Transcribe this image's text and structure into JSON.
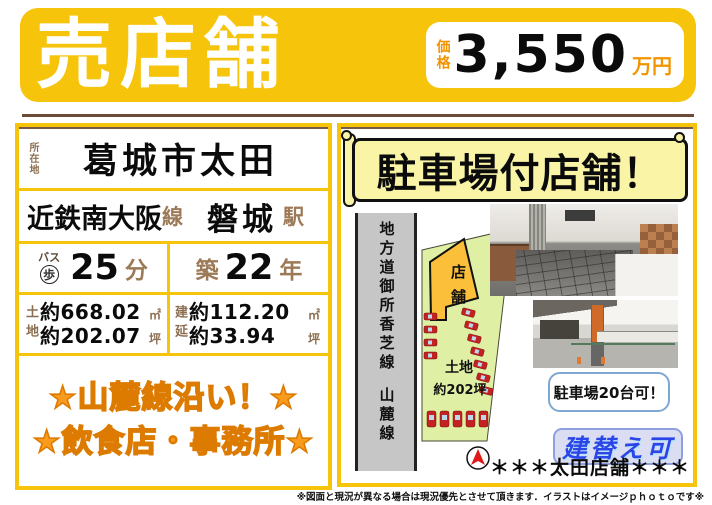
{
  "banner": {
    "title": "売店舗",
    "price_label": "価格",
    "price_value": "3,550",
    "price_unit": "万円"
  },
  "left_panel": {
    "location_label": "所在地",
    "location": "葛城市太田",
    "rail_line": "近鉄南大阪",
    "rail_line_suffix": "線",
    "station": "磐城",
    "station_suffix": "駅",
    "access_bus": "バス",
    "access_walk": "歩",
    "access_minutes": "25",
    "access_unit": "分",
    "built_label": "築",
    "built_years": "22",
    "built_unit": "年",
    "land_label": "土地",
    "land_m2": "約668.02",
    "land_m2_unit": "㎡",
    "land_tsubo": "約202.07",
    "land_tsubo_unit": "坪",
    "bldg_label": "建延",
    "bldg_m2": "約112.20",
    "bldg_m2_unit": "㎡",
    "bldg_tsubo": "約33.94",
    "bldg_tsubo_unit": "坪",
    "catch_line1": "★山麓線沿い！★",
    "catch_line2": "★飲食店・事務所★"
  },
  "right_panel": {
    "headline": "駐車場付店舗！",
    "map": {
      "road_label": "地方道御所香芝線",
      "road_label2": "山麓線",
      "building_label": "店舗",
      "land_caption1": "土地",
      "land_caption2": "約202坪"
    },
    "notes": {
      "parking": "駐車場20台可！",
      "rebuild": "建替え可"
    },
    "property_name": "＊＊＊太田店舗＊＊＊"
  },
  "footer": {
    "disclaimer": "※図面と現況が異なる場合は現況優先とさせて頂きます．イラストはイメージｐｈｏｔｏです※"
  },
  "icons": {
    "compass": "north-arrow-icon",
    "cars": "parked-car-icon",
    "walk_circle": "circled-walk-icon"
  },
  "colors": {
    "accent_yellow": "#F6C40A",
    "divider_brown": "#6B4A38",
    "label_brown": "#8C6F52",
    "price_orange": "#F29400",
    "star_orange": "#F99C1E",
    "star_outline": "#DD7A00",
    "scroll_bg": "#FAF4A6",
    "land_green": "#DFF0A4",
    "building_orange": "#FBBF3A",
    "car_red": "#C32222",
    "note_border_blue": "#7FA8D0",
    "rebuild_blue": "#2B45E8"
  }
}
